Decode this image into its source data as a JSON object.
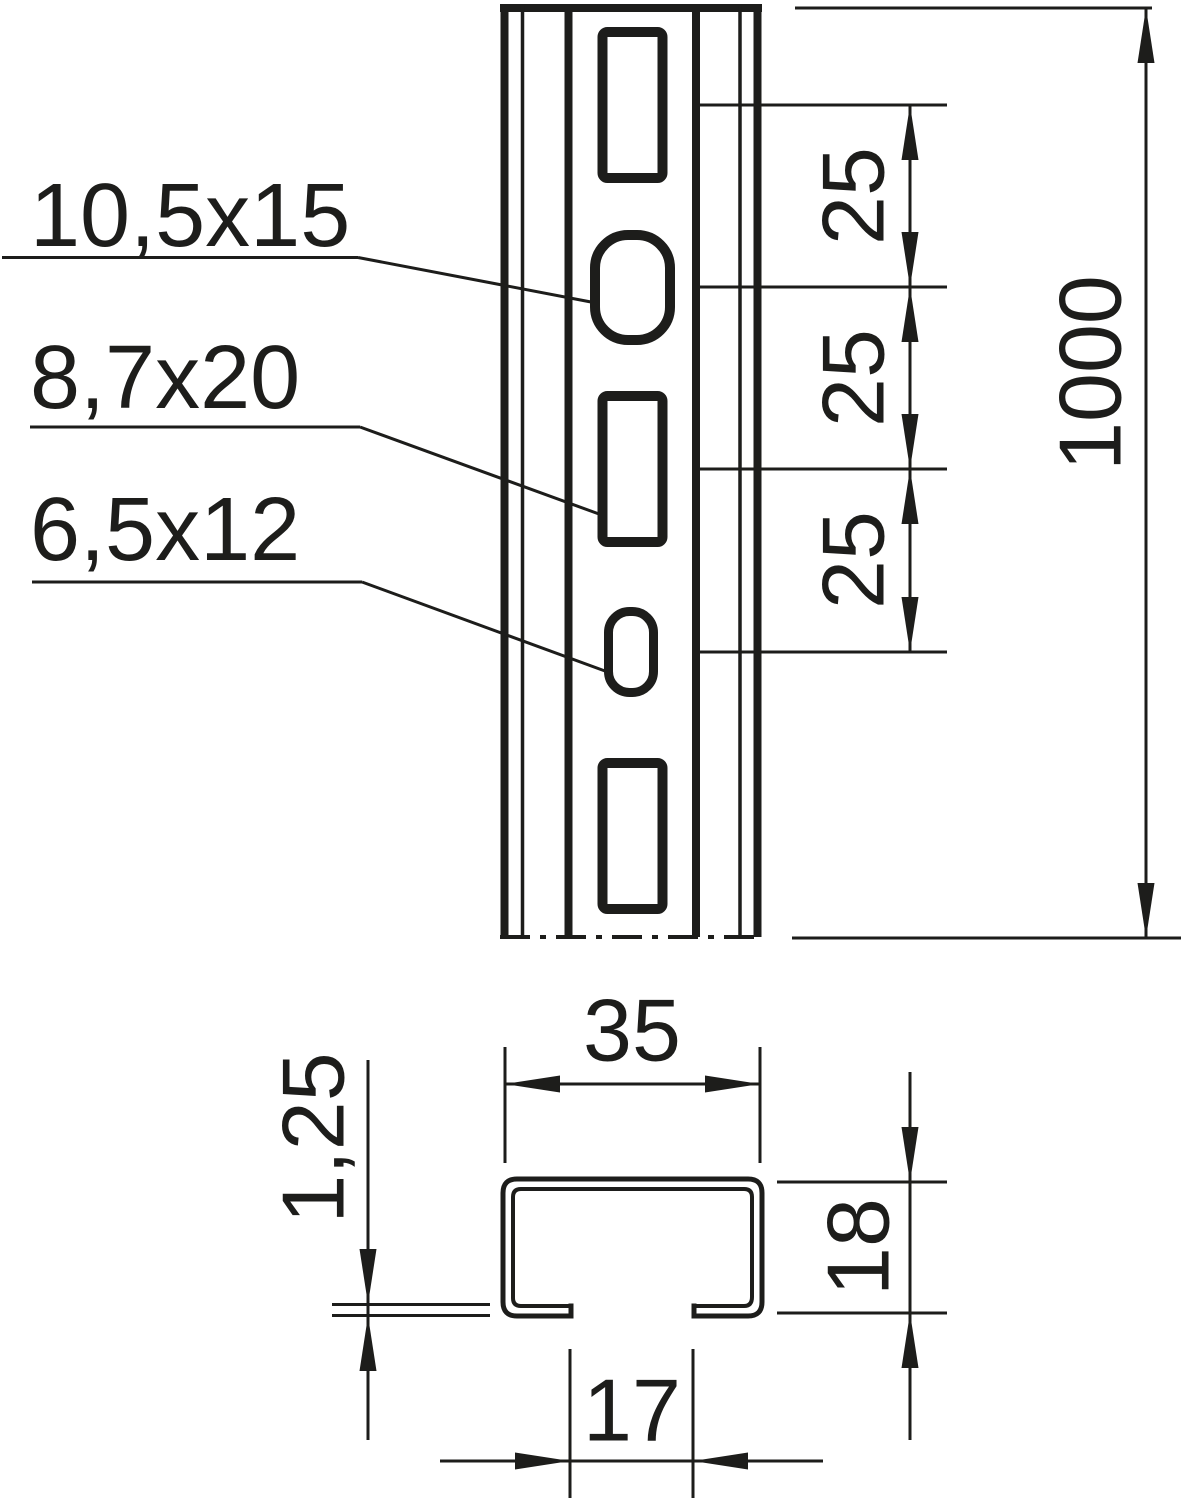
{
  "colors": {
    "ink": "#1d1d1b",
    "background": "#ffffff"
  },
  "front_view": {
    "name": "profile rail front view with hole pattern",
    "hole_labels": [
      {
        "label": "10,5x15",
        "target": "obround-slot"
      },
      {
        "label": "8,7x20",
        "target": "rectangular-slot"
      },
      {
        "label": "6,5x12",
        "target": "small-obround-slot"
      }
    ],
    "pitch_dimensions": [
      {
        "value": "25"
      },
      {
        "value": "25"
      },
      {
        "value": "25"
      }
    ],
    "length_dimension": {
      "value": "1000"
    }
  },
  "cross_section": {
    "name": "profile rail cross-section",
    "width_dimension": {
      "value": "35"
    },
    "height_dimension": {
      "value": "18"
    },
    "opening_dimension": {
      "value": "17"
    },
    "thickness_dimension": {
      "value": "1,25"
    }
  }
}
